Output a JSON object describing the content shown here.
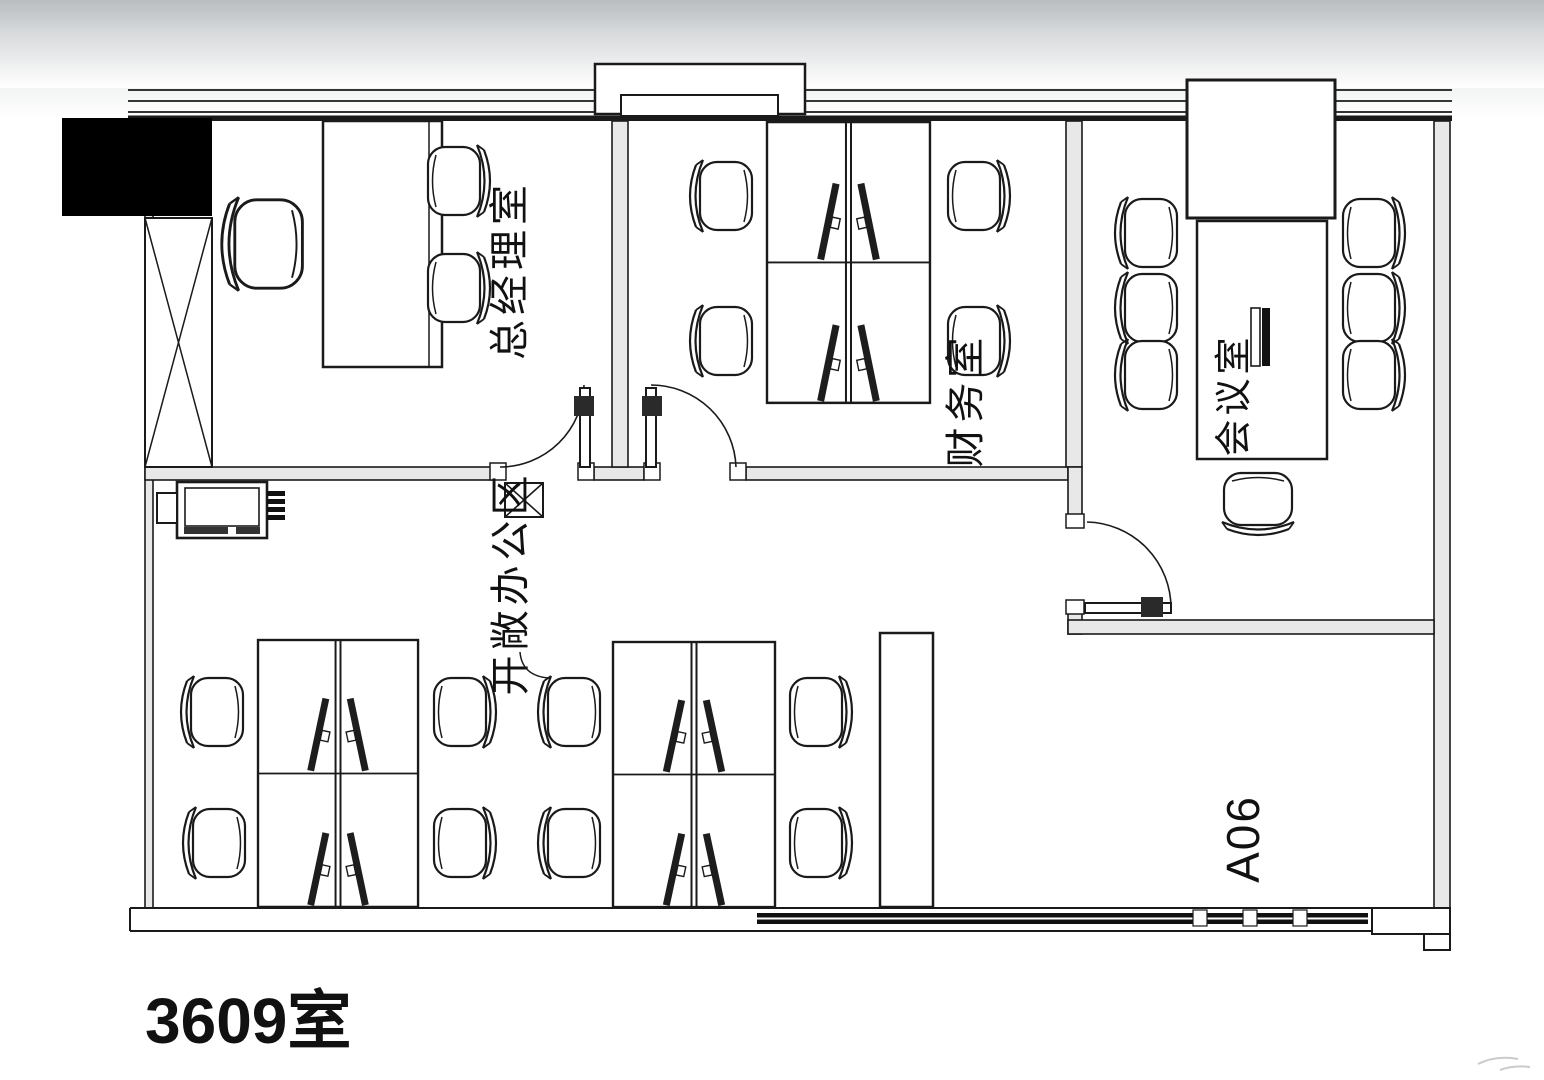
{
  "page": {
    "title": "3609室",
    "unit_code": "A06"
  },
  "floorplan": {
    "type": "office-floor-plan",
    "rooms": [
      {
        "id": "gm-office",
        "label": "总经理室",
        "furniture": {
          "desks": 1,
          "executive_chairs": 1,
          "guest_chairs": 2,
          "shaft_hatch": 1
        }
      },
      {
        "id": "finance-room",
        "label": "财务室",
        "furniture": {
          "workstations": 4,
          "chairs": 4,
          "monitors": 4,
          "doors": 1
        }
      },
      {
        "id": "meeting-room",
        "label": "会议室",
        "furniture": {
          "conference_tables": 1,
          "chairs": 7,
          "wall_cabinets": 1,
          "doors": 1
        }
      },
      {
        "id": "open-office",
        "label": "开敞办公区",
        "furniture": {
          "workstations": 8,
          "chairs": 8,
          "monitors": 8,
          "printers": 1,
          "tall_cabinets": 1
        }
      }
    ],
    "annotations": {
      "unit_code": "A06",
      "room_number": "3609室"
    },
    "colors": {
      "line": "#1a1a1a",
      "wall_fill": "#e8e8e8",
      "mask": "#000000",
      "background": "#ffffff"
    }
  }
}
